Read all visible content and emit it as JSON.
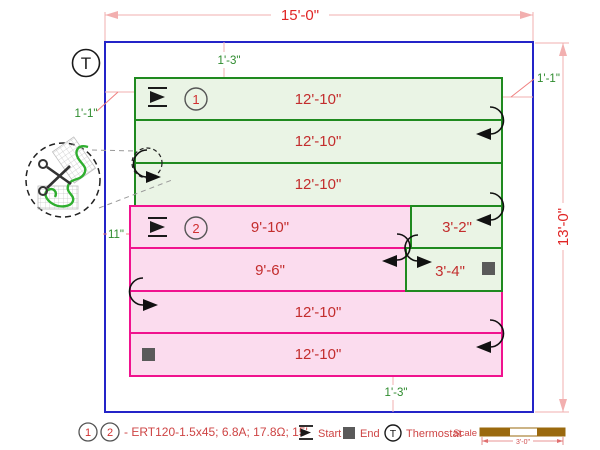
{
  "dimensions": {
    "room_width": "15'-0\"",
    "room_height": "13'-0\"",
    "offset_top": "1'-3\"",
    "offset_left": "1'-1\"",
    "offset_right": "1'-1\"",
    "offset_left_mid": "11\"",
    "offset_bottom": "1'-3\""
  },
  "thermostat": {
    "symbol": "T"
  },
  "mats": {
    "mat1": {
      "number": "1",
      "rows": [
        "12'-10\"",
        "12'-10\"",
        "12'-10\"",
        "3'-2\"",
        "3'-4\""
      ]
    },
    "mat2": {
      "number": "2",
      "rows": [
        "9'-10\"",
        "9'-6\"",
        "12'-10\"",
        "12'-10\""
      ]
    }
  },
  "legend": {
    "num1": "1",
    "num2": "2",
    "spec": "- ERT120-1.5x45; 6.8A; 17.8Ω; 15'",
    "start_label": "Start",
    "end_label": "End",
    "thermostat_symbol": "T",
    "thermostat_label": "Thermostat",
    "scale_label": "Scale",
    "scale_length": "3'-0\""
  },
  "colors": {
    "room_outline": "#2424C8",
    "mat1_border": "#1F8A1F",
    "mat1_fill": "#EAF4E5",
    "mat2_border": "#F0128E",
    "mat2_fill": "#FBDCEE",
    "dimension_line": "#F2AFAF",
    "dimension_text": "#E02525",
    "offset_text": "#2E8B2E",
    "row_text": "#C32D2D",
    "legend_text": "#CE4444",
    "scale_bar": "#9A690E",
    "end_marker": "#5A5A5A"
  }
}
